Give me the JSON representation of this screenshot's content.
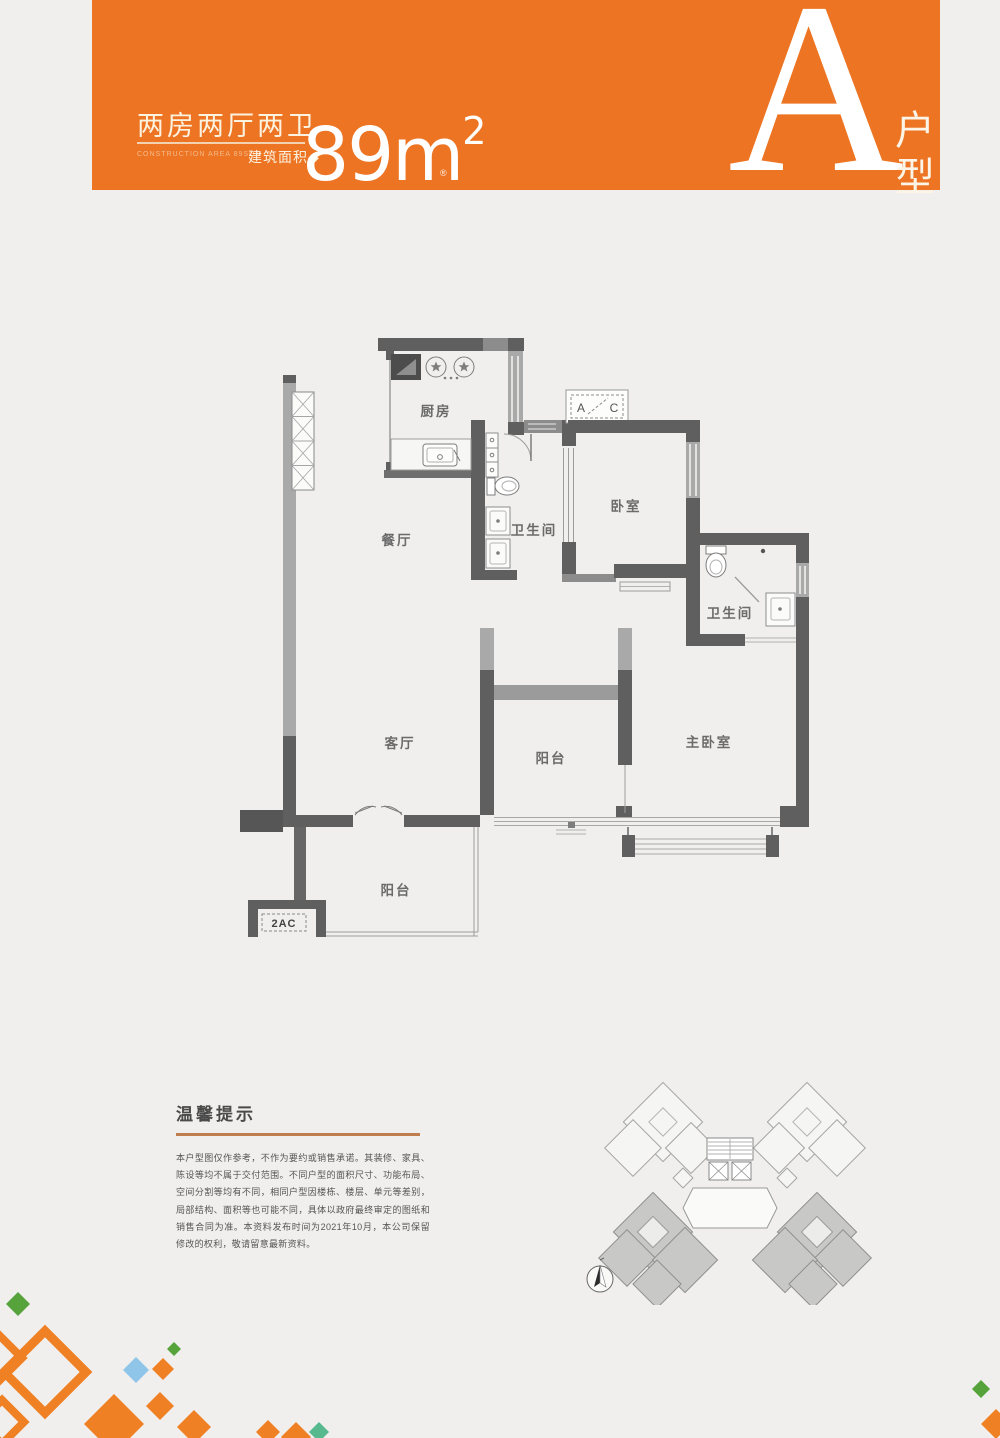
{
  "header": {
    "accent_color": "#ED7422",
    "title_cn": "两房两厅两卫",
    "subtitle_en": "CONSTRUCTION AREA 89SQM",
    "area_label": "建筑面积◆",
    "area_value": "89m",
    "area_sup": "2",
    "registered_mark": "®",
    "unit_letter": "A",
    "unit_type_chars": {
      "top": "户",
      "bottom": "型"
    }
  },
  "floorplan": {
    "rooms": [
      {
        "name": "厨房"
      },
      {
        "name": "餐厅"
      },
      {
        "name": "卫生间"
      },
      {
        "name": "卧室"
      },
      {
        "name": "卫生间"
      },
      {
        "name": "主卧室"
      },
      {
        "name": "客厅"
      },
      {
        "name": "阳台"
      },
      {
        "name": "阳台"
      }
    ],
    "labels": {
      "ac_left": "A",
      "ac_right": "C",
      "unit_code": "2AC"
    }
  },
  "tips": {
    "title": "温馨提示",
    "underline_color": "#c07e4e",
    "body": "本户型图仅作参考，不作为要约或销售承诺。其装修、家具、陈设等均不属于交付范围。不同户型的面积尺寸、功能布局、空间分割等均有不同，相同户型因楼栋、楼层、单元等差别，局部结构、面积等也可能不同，具体以政府最终审定的图纸和销售合同为准。本资料发布时间为2021年10月，本公司保留修改的权利，敬请留意最新资料。"
  },
  "decor_colors": {
    "orange": "#EF8124",
    "green": "#55A33A",
    "blue": "#8FC5E9",
    "teal": "#58B98E"
  }
}
